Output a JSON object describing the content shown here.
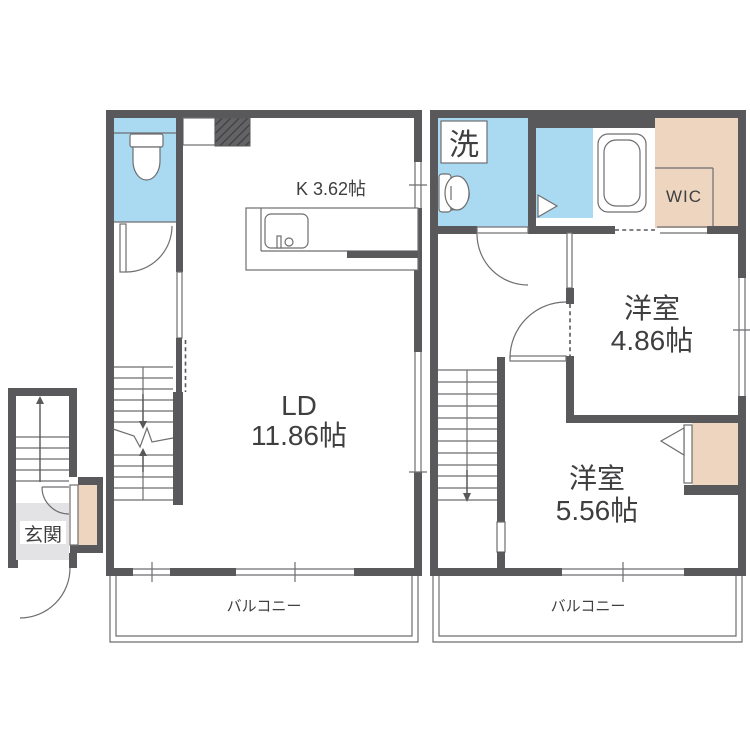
{
  "plan": {
    "floor1": {
      "entrance_label": "玄関",
      "kitchen_label": "K 3.62帖",
      "living_label": "LD",
      "living_size": "11.86帖",
      "balcony_label": "バルコニー"
    },
    "floor2": {
      "laundry_label": "洗",
      "wic_label": "WIC",
      "bedroom1_label": "洋室",
      "bedroom1_size": "4.86帖",
      "bedroom2_label": "洋室",
      "bedroom2_size": "5.56帖",
      "balcony_label": "バルコニー"
    },
    "colors": {
      "wall": "#59595b",
      "water_room": "#a9daf2",
      "closet": "#edd5bf",
      "entry_floor": "#e3e3e6",
      "line": "#6e6e70",
      "text": "#3f3f41"
    }
  }
}
